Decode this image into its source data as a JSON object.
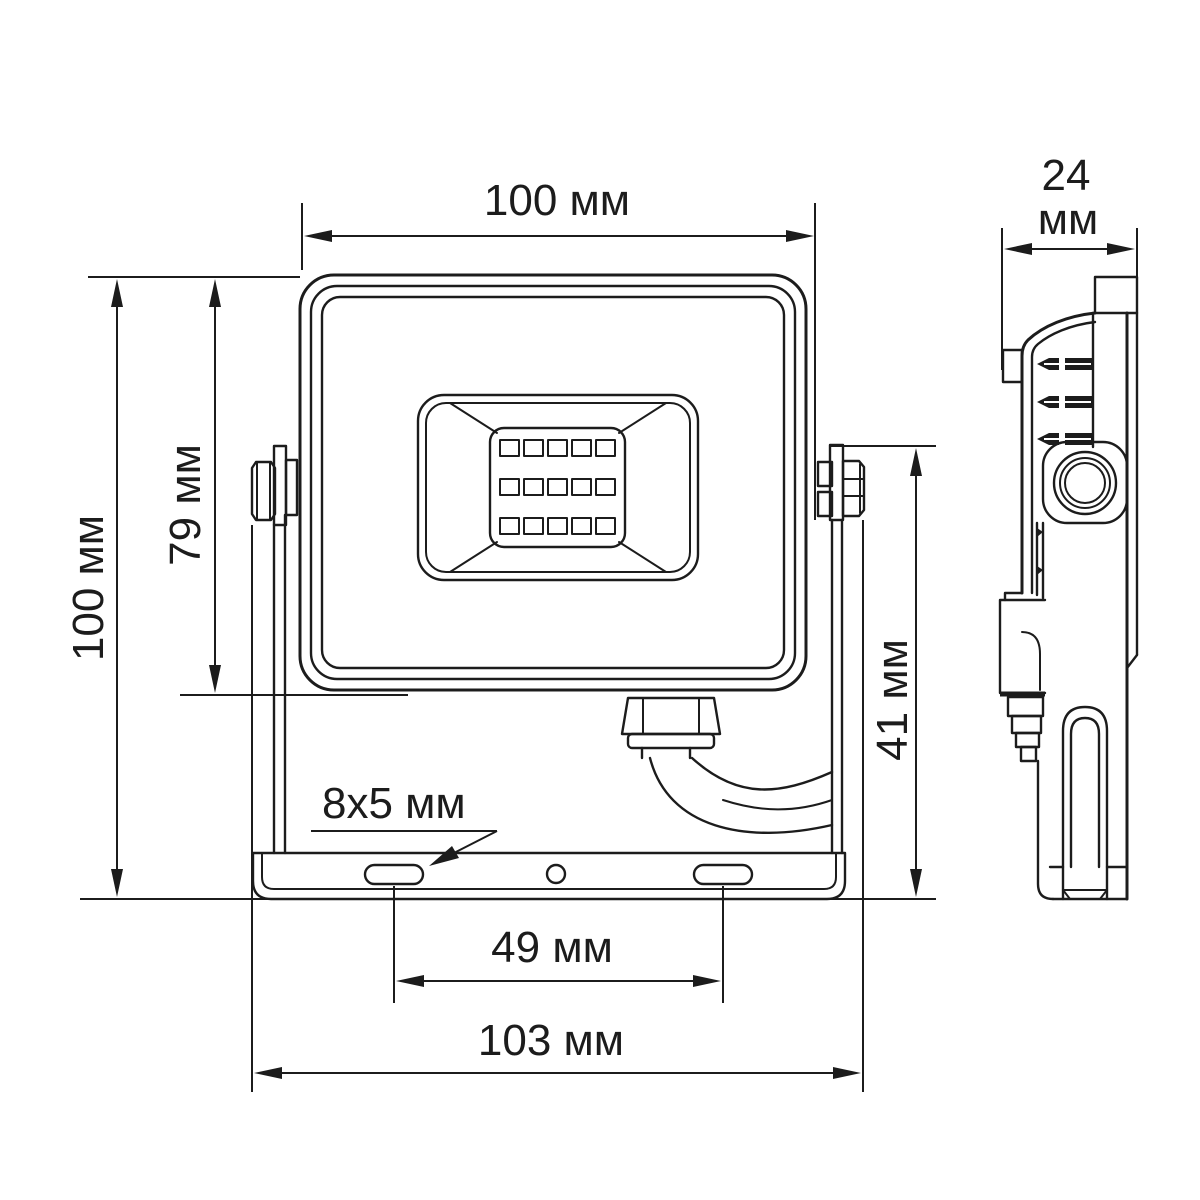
{
  "drawing": {
    "kind": "floodlight-dimension-drawing",
    "unit": "мм",
    "colors": {
      "line": "#1c1c1c",
      "background": "#ffffff"
    },
    "dims": {
      "front_width": "100 мм",
      "depth_value": "24",
      "depth_unit": "мм",
      "overall_height": "100 мм",
      "body_height": "79 мм",
      "bracket_height": "41 мм",
      "slot_size": "8x5 мм",
      "slot_spacing": "49 мм",
      "overall_width": "103 мм"
    }
  }
}
